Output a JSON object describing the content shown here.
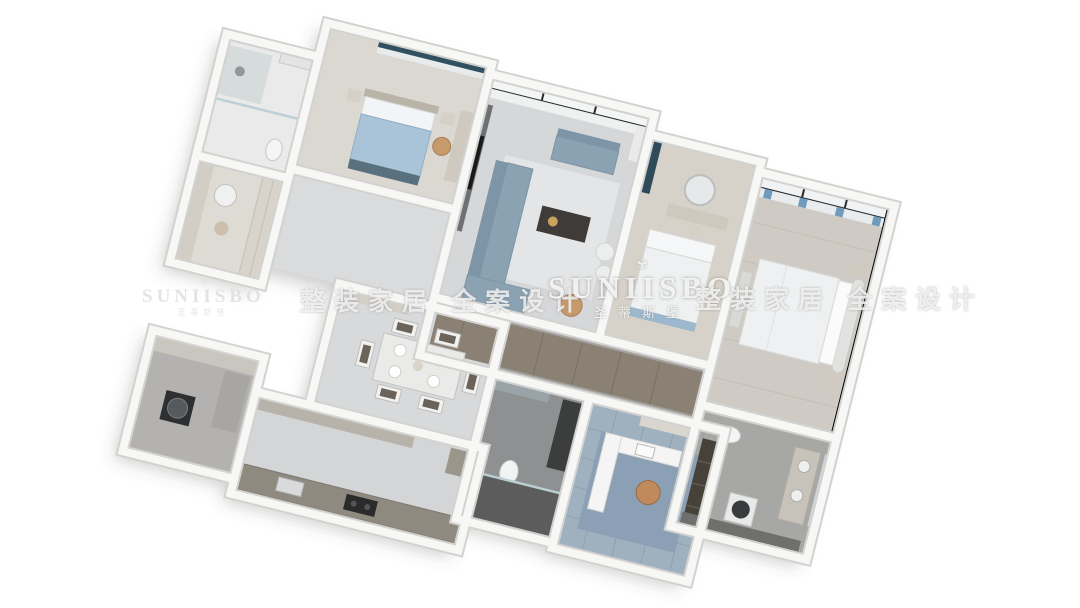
{
  "watermarks": {
    "brand_latin": "SUNIISBO",
    "brand_cn": "圣蒂斯堡",
    "slogan": "整装家居 全案设计",
    "crown_icon": "✾"
  },
  "palette": {
    "background": "#ffffff",
    "wall_white": "#f7f7f5",
    "wall_edge": "#d2d2d0",
    "floor_marble": "#d6d7d9",
    "floor_wood_light": "#d7d2c9",
    "floor_wood_master": "#cfcbc4",
    "floor_concrete_gray": "#a3a2a0",
    "floor_shower_dark": "#5b5c5b",
    "floor_tile_blue": "#9fb0bf",
    "corridor_wood": "#8a8074",
    "sofa_blue_gray": "#8ba2b3",
    "curtain_teal": "#2f4a59",
    "bed_blanket_blue": "#a9c3d8",
    "bedding_white": "#eef0f1",
    "accent_tan_chair": "#c79a6b",
    "coffee_table_dark": "#3f3b38",
    "window_frame_black": "#2b2b2b",
    "kitchen_cabinet_greige": "#8f8a80",
    "appliance_dark": "#2e2f31"
  },
  "rooms": [
    "bedroom-2",
    "ensuite-bathroom",
    "walk-in-vanity",
    "living-room",
    "bedroom-3-vanity",
    "master-bedroom",
    "hallway",
    "dining-room",
    "shower-bathroom",
    "study",
    "master-bathroom",
    "kitchen",
    "laundry-utility"
  ]
}
